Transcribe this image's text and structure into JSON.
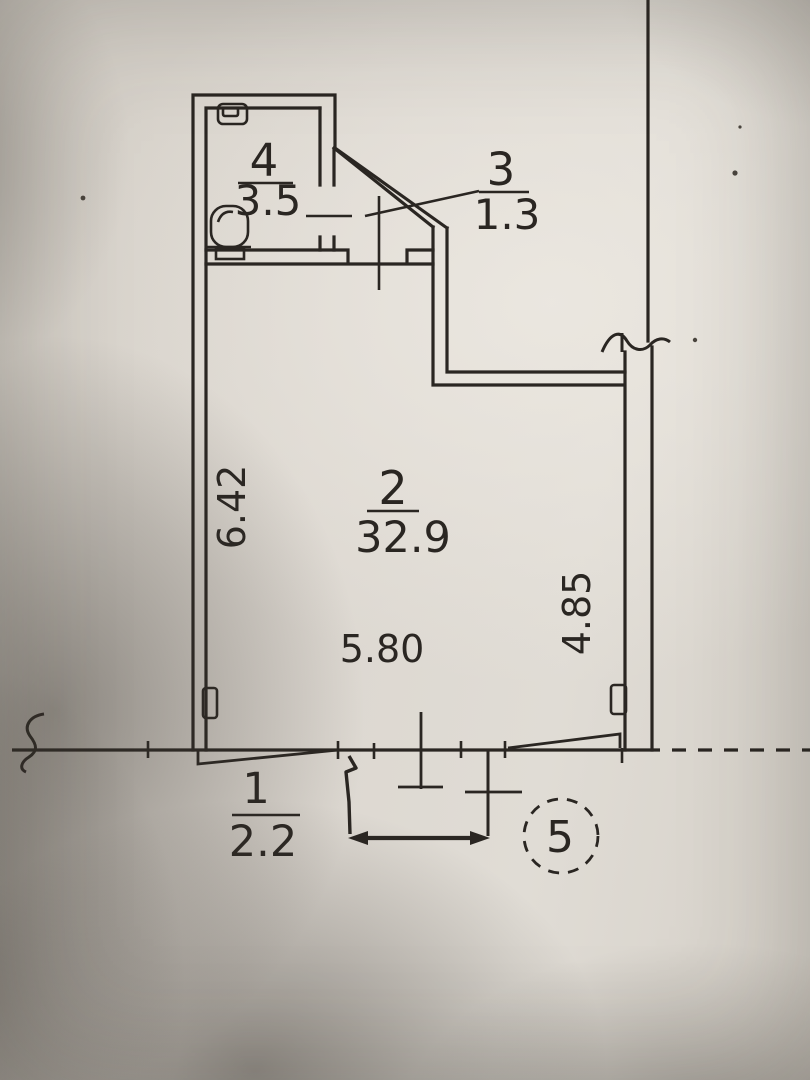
{
  "colors": {
    "paper": "#dcd7cf",
    "ink": "#2a2622"
  },
  "plan": {
    "rooms": [
      {
        "number": "4",
        "area": "3.5"
      },
      {
        "number": "3",
        "area": "1.3"
      },
      {
        "number": "2",
        "area": "32.9"
      },
      {
        "number": "1",
        "area": "2.2"
      }
    ],
    "dimensions": {
      "left": "6.42",
      "bottom": "5.80",
      "right": "4.85"
    },
    "detail_marker": "5"
  }
}
